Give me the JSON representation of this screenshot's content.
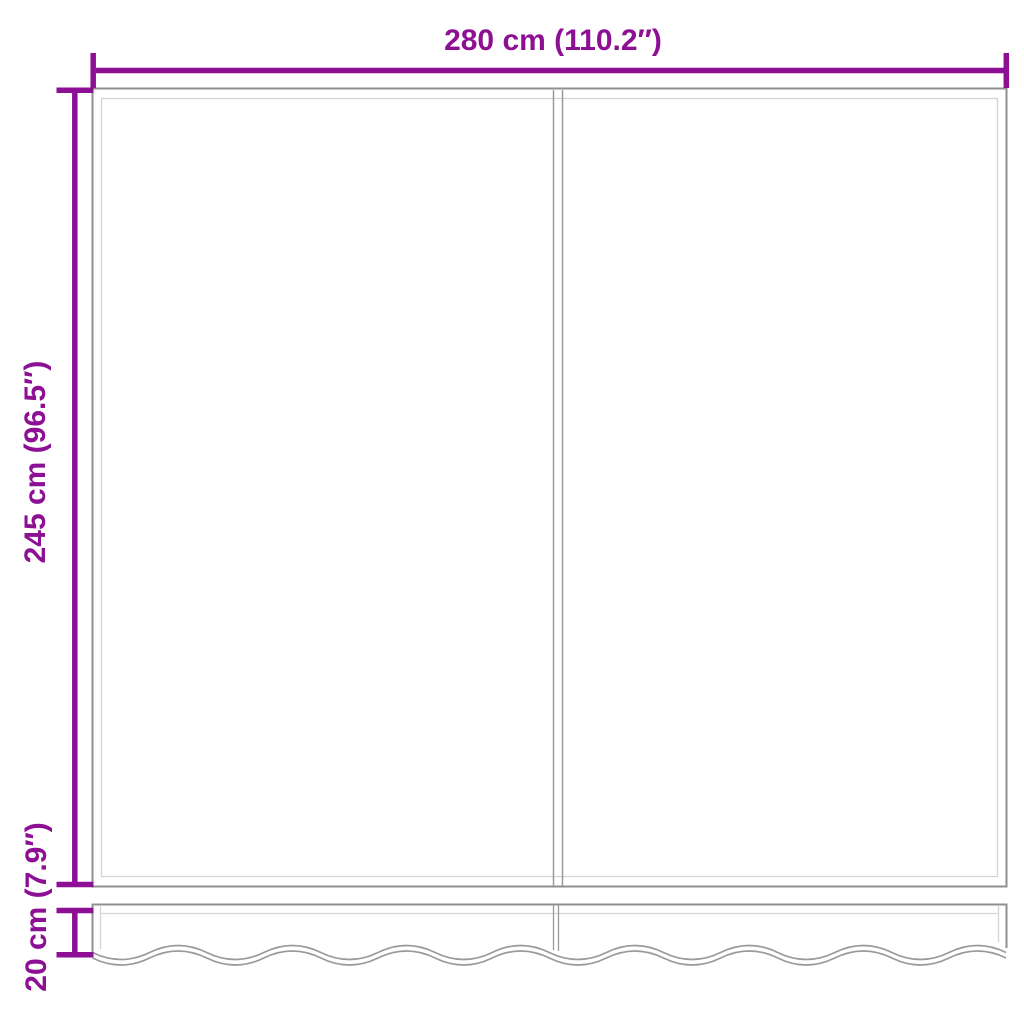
{
  "diagram": {
    "title": "awning-fabric-dimension-diagram",
    "width_label": "280 cm (110.2″)",
    "height_label": "245 cm (96.5″)",
    "valance_label": "20 cm (7.9″)",
    "colors": {
      "dimension_accent": "#8C0F94",
      "fabric_outline": "#8F8F8F",
      "seam_line": "#9A9A9A",
      "hem_line": "#D4D4D4",
      "background": "#FFFFFF"
    }
  }
}
